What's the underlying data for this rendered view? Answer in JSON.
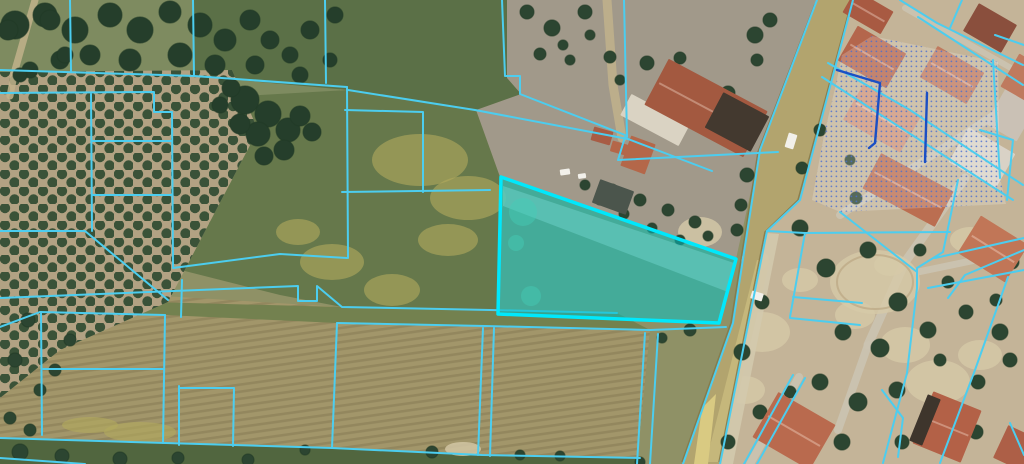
{
  "map": {
    "canvas": {
      "width": 1024,
      "height": 464
    },
    "type": "cadastral-parcel-aerial-view",
    "colors": {
      "base_ground": "#8f9166",
      "parcel_line": "#4ccdef",
      "selected_stroke": "#00e8fc",
      "selected_fill": "rgba(0,195,200,0.52)",
      "navy_line": "#1b4fc4",
      "stipple_dot": "#4a6ed0",
      "stipple_wash": "rgba(255,255,255,0.20)",
      "road_fill": "#b2a46e",
      "road_light": "#c9bb7e",
      "road_wedge": "#d9ca82",
      "road_edge": "#847849",
      "sidewalk": "#d3c9ad",
      "street_gray": "#cbc3b1",
      "tree_dark": "#2c4531",
      "tree_rim": "#223a27",
      "olive_tree": "#3a5238",
      "grove_soil": "#b2a283",
      "sand_patch": "#d6c9a8",
      "flower_patch": "#b3aa5e",
      "tan_path": "#c1b18b",
      "rows_stroke": "rgba(80,65,40,0.18)",
      "white_object": "#f2f0ea"
    },
    "fields": [
      {
        "n": "top-left-grass",
        "p": "0,0 340,0 340,100 0,100",
        "f": "#7e8b60"
      },
      {
        "n": "residential-right",
        "p": "853,0 1024,0 1024,464 720,464 767,231 800,200",
        "f": "#c4b498"
      },
      {
        "n": "dirt-area-center",
        "p": "507,0 817,0 760,150 736,259 500,177 476,110 521,94 507,78",
        "f": "#a1998a"
      },
      {
        "n": "top-center-field",
        "p": "193,0 507,0 507,78 521,94 476,110 348,90 194,76",
        "f": "#5b7047"
      },
      {
        "n": "small-parcels-left",
        "p": "91,93 173,100 173,268 120,280 91,231",
        "f": "#6d7e52"
      },
      {
        "n": "center-green-block",
        "p": "173,100 348,90 476,110 500,177 499,314 342,307 280,295 173,268",
        "f": "#66784b"
      },
      {
        "n": "brown-strip-fields",
        "p": "0,286 342,307 490,310 617,313 650,330 637,464 0,464",
        "f": "#a2966a",
        "rows": true
      },
      {
        "n": "grass-band",
        "p": "0,298 342,307 617,313 650,330 337,323 165,315 40,312 0,327",
        "f": "#73814f"
      },
      {
        "n": "bottom-green-band",
        "p": "0,438 332,448 482,455 640,458 637,464 0,464",
        "f": "#51663f"
      }
    ],
    "grove": {
      "p": "0,72 232,70 258,130 168,302 60,350 0,398",
      "soil": "#b2a283"
    },
    "tan_paths": [
      {
        "pts": "35,0 15,70 10,96",
        "w": 7
      },
      {
        "pts": "607,0 613,85 622,138",
        "w": 9
      }
    ],
    "streets": [
      {
        "pts": "965,178 905,262 868,345",
        "w": 9
      },
      {
        "pts": "840,215 1005,108",
        "w": 8
      },
      {
        "pts": "918,272 1024,250",
        "w": 7
      },
      {
        "pts": "905,8 1018,72",
        "w": 6
      },
      {
        "pts": "868,345 838,430",
        "w": 8
      },
      {
        "pts": "799,377 750,464",
        "w": 8
      }
    ],
    "sand_patches": [
      [
        875,
        282,
        45,
        32
      ],
      [
        762,
        332,
        28,
        20
      ],
      [
        938,
        382,
        32,
        22
      ],
      [
        700,
        232,
        22,
        15
      ],
      [
        905,
        345,
        25,
        18
      ],
      [
        855,
        315,
        20,
        14
      ],
      [
        980,
        355,
        22,
        15
      ],
      [
        745,
        390,
        20,
        14
      ],
      [
        800,
        280,
        18,
        12
      ],
      [
        970,
        240,
        20,
        13
      ],
      [
        890,
        265,
        16,
        11
      ],
      [
        755,
        260,
        14,
        10
      ],
      [
        463,
        449,
        18,
        7
      ]
    ],
    "dirt_ring": [
      875,
      282,
      38,
      27
    ],
    "flower_patches": [
      [
        420,
        160,
        48,
        26
      ],
      [
        468,
        198,
        38,
        22
      ],
      [
        332,
        262,
        32,
        18
      ],
      [
        392,
        290,
        28,
        16
      ],
      [
        298,
        232,
        22,
        13
      ],
      [
        448,
        240,
        30,
        16
      ],
      [
        140,
        432,
        36,
        10
      ],
      [
        90,
        425,
        28,
        8
      ]
    ],
    "road": {
      "body": "817,0 853,0 800,200 767,231 720,464 683,464 733,323 760,150",
      "light": "757,260 770,260 722,462 706,462",
      "wedge": "702,408 716,394 708,464 694,464",
      "edge_left": "815,4 758,152 731,323 682,462",
      "edge_right": "851,4 798,200 765,232 719,462",
      "sidewalk": "767,233 779,234 733,464 721,464"
    },
    "tree_clusters": [
      [
        15,
        25,
        14
      ],
      [
        45,
        15,
        12
      ],
      [
        75,
        30,
        13
      ],
      [
        110,
        15,
        12
      ],
      [
        140,
        30,
        13
      ],
      [
        170,
        12,
        11
      ],
      [
        200,
        25,
        12
      ],
      [
        225,
        40,
        11
      ],
      [
        90,
        55,
        10
      ],
      [
        130,
        60,
        11
      ],
      [
        180,
        55,
        12
      ],
      [
        215,
        65,
        10
      ],
      [
        60,
        60,
        9
      ],
      [
        30,
        70,
        8
      ],
      [
        250,
        20,
        10
      ],
      [
        270,
        40,
        9
      ],
      [
        255,
        65,
        9
      ],
      [
        290,
        55,
        8
      ],
      [
        310,
        30,
        9
      ],
      [
        335,
        15,
        8
      ],
      [
        300,
        75,
        8
      ],
      [
        330,
        60,
        7
      ],
      [
        8,
        30,
        10
      ],
      [
        50,
        20,
        10
      ],
      [
        65,
        55,
        8
      ],
      [
        20,
        75,
        7
      ],
      [
        245,
        100,
        14
      ],
      [
        268,
        114,
        13
      ],
      [
        288,
        130,
        12
      ],
      [
        258,
        134,
        12
      ],
      [
        240,
        124,
        10
      ],
      [
        300,
        116,
        10
      ],
      [
        312,
        132,
        9
      ],
      [
        284,
        150,
        10
      ],
      [
        264,
        156,
        9
      ],
      [
        231,
        88,
        9
      ],
      [
        220,
        105,
        8
      ]
    ],
    "trees": [
      [
        527,
        12,
        7
      ],
      [
        552,
        28,
        8
      ],
      [
        585,
        12,
        7
      ],
      [
        540,
        54,
        6
      ],
      [
        570,
        60,
        5
      ],
      [
        610,
        57,
        6
      ],
      [
        647,
        63,
        7
      ],
      [
        680,
        58,
        6
      ],
      [
        700,
        88,
        8
      ],
      [
        728,
        93,
        7
      ],
      [
        757,
        60,
        6
      ],
      [
        660,
        93,
        6
      ],
      [
        620,
        80,
        5
      ],
      [
        590,
        35,
        5
      ],
      [
        563,
        45,
        5
      ],
      [
        755,
        35,
        8
      ],
      [
        770,
        20,
        7
      ],
      [
        747,
        175,
        7
      ],
      [
        741,
        205,
        6
      ],
      [
        737,
        230,
        6
      ],
      [
        612,
        190,
        6
      ],
      [
        640,
        200,
        6
      ],
      [
        668,
        210,
        6
      ],
      [
        695,
        222,
        6
      ],
      [
        652,
        228,
        5
      ],
      [
        624,
        214,
        5
      ],
      [
        600,
        200,
        5
      ],
      [
        680,
        240,
        5
      ],
      [
        708,
        236,
        5
      ],
      [
        585,
        185,
        5
      ],
      [
        800,
        228,
        8
      ],
      [
        826,
        268,
        9
      ],
      [
        868,
        250,
        8
      ],
      [
        898,
        302,
        9
      ],
      [
        843,
        332,
        8
      ],
      [
        880,
        348,
        9
      ],
      [
        928,
        330,
        8
      ],
      [
        966,
        312,
        7
      ],
      [
        1000,
        332,
        8
      ],
      [
        820,
        382,
        8
      ],
      [
        858,
        402,
        9
      ],
      [
        897,
        390,
        8
      ],
      [
        742,
        352,
        8
      ],
      [
        762,
        302,
        7
      ],
      [
        978,
        382,
        7
      ],
      [
        1012,
        262,
        7
      ],
      [
        948,
        282,
        6
      ],
      [
        760,
        412,
        7
      ],
      [
        728,
        442,
        7
      ],
      [
        790,
        392,
        6
      ],
      [
        842,
        442,
        8
      ],
      [
        976,
        432,
        7
      ],
      [
        902,
        442,
        7
      ],
      [
        856,
        198,
        6
      ],
      [
        930,
        205,
        7
      ],
      [
        820,
        130,
        6
      ],
      [
        802,
        168,
        6
      ],
      [
        850,
        160,
        5
      ],
      [
        920,
        250,
        6
      ],
      [
        1010,
        360,
        7
      ],
      [
        940,
        360,
        6
      ],
      [
        996,
        300,
        6
      ],
      [
        690,
        330,
        6
      ],
      [
        662,
        338,
        5
      ],
      [
        20,
        452,
        8
      ],
      [
        62,
        456,
        7
      ],
      [
        120,
        459,
        7
      ],
      [
        178,
        458,
        6
      ],
      [
        248,
        460,
        6
      ],
      [
        305,
        450,
        5
      ],
      [
        432,
        452,
        6
      ],
      [
        520,
        455,
        5
      ],
      [
        560,
        456,
        5
      ],
      [
        640,
        462,
        5
      ],
      [
        28,
        320,
        7
      ],
      [
        15,
        360,
        7
      ],
      [
        40,
        390,
        6
      ],
      [
        10,
        418,
        6
      ],
      [
        55,
        370,
        6
      ],
      [
        30,
        430,
        6
      ],
      [
        70,
        340,
        6
      ]
    ],
    "buildings": [
      {
        "cx": 868,
        "cy": 12,
        "w": 44,
        "h": 26,
        "rot": 30,
        "f": "#a85a42",
        "ridge": true
      },
      {
        "cx": 872,
        "cy": 57,
        "w": 56,
        "h": 40,
        "rot": 30,
        "f": "#b4664c",
        "ridge": true
      },
      {
        "cx": 952,
        "cy": 75,
        "w": 54,
        "h": 36,
        "rot": 30,
        "f": "#bf7a5e",
        "ridge": true
      },
      {
        "cx": 990,
        "cy": 28,
        "w": 44,
        "h": 32,
        "rot": 30,
        "f": "#8a4f3d",
        "ridge": false
      },
      {
        "cx": 882,
        "cy": 118,
        "w": 66,
        "h": 42,
        "rot": 30,
        "f": "#ce9478",
        "ridge": true
      },
      {
        "cx": 982,
        "cy": 158,
        "w": 54,
        "h": 40,
        "rot": 30,
        "f": "#d9d2c6",
        "ridge": false
      },
      {
        "cx": 1014,
        "cy": 110,
        "w": 36,
        "h": 52,
        "rot": 30,
        "f": "#cac1b5",
        "ridge": false
      },
      {
        "cx": 908,
        "cy": 190,
        "w": 82,
        "h": 40,
        "rot": 28,
        "f": "#bb6e51",
        "ridge": true
      },
      {
        "cx": 993,
        "cy": 249,
        "w": 56,
        "h": 44,
        "rot": 32,
        "f": "#c17657",
        "ridge": true
      },
      {
        "cx": 655,
        "cy": 120,
        "w": 66,
        "h": 24,
        "rot": 28,
        "f": "#dad3c3",
        "ridge": false
      },
      {
        "cx": 706,
        "cy": 108,
        "w": 112,
        "h": 52,
        "rot": 28,
        "f": "#a35940",
        "ridge": true
      },
      {
        "cx": 737,
        "cy": 122,
        "w": 52,
        "h": 40,
        "rot": 28,
        "f": "#43392f",
        "ridge": false
      },
      {
        "cx": 638,
        "cy": 155,
        "w": 26,
        "h": 32,
        "rot": 20,
        "f": "#b46749",
        "ridge": false
      },
      {
        "cx": 602,
        "cy": 136,
        "w": 20,
        "h": 14,
        "rot": 16,
        "f": "#a85c44",
        "ridge": false
      },
      {
        "cx": 619,
        "cy": 148,
        "w": 16,
        "h": 11,
        "rot": 16,
        "f": "#b46749",
        "ridge": false
      },
      {
        "cx": 613,
        "cy": 197,
        "w": 36,
        "h": 25,
        "rot": 20,
        "f": "#4b554c",
        "ridge": false
      },
      {
        "cx": 794,
        "cy": 431,
        "w": 66,
        "h": 52,
        "rot": 30,
        "f": "#b96a4e",
        "ridge": true
      },
      {
        "cx": 947,
        "cy": 427,
        "w": 52,
        "h": 56,
        "rot": 22,
        "f": "#b36147",
        "ridge": true
      },
      {
        "cx": 925,
        "cy": 420,
        "w": 14,
        "h": 50,
        "rot": 22,
        "f": "#3e352c",
        "ridge": false
      },
      {
        "cx": 1017,
        "cy": 449,
        "w": 36,
        "h": 36,
        "rot": 25,
        "f": "#ad5f47",
        "ridge": false
      },
      {
        "cx": 1022,
        "cy": 77,
        "w": 28,
        "h": 38,
        "rot": 30,
        "f": "#bf7a5e",
        "ridge": false
      }
    ],
    "white_objects": [
      [
        791,
        141,
        9,
        15,
        17
      ],
      [
        757,
        296,
        12,
        8,
        17
      ],
      [
        565,
        172,
        10,
        6,
        -8
      ],
      [
        582,
        176,
        8,
        5,
        -8
      ]
    ],
    "selected_parcel": {
      "points": "501,177 736,259 719,323 498,314",
      "inner_light_band": "503,186 734,263 728,292 503,206",
      "inner_green_patches": [
        [
          523,
          212,
          14
        ],
        [
          531,
          296,
          10
        ],
        [
          516,
          243,
          8
        ]
      ]
    },
    "stipple_zone": {
      "p": "842,55 872,36 998,62 1000,178 1006,204 840,212 812,200 824,135 836,84"
    },
    "parcel_lines": [
      "70,0 71,71",
      "0,70 194,76",
      "193,0 194,76",
      "194,76 347,87",
      "325,0 326,83",
      "347,87 348,258",
      "0,93 154,92 154,112 172,112 173,268",
      "91,94 92,231",
      "92,141 172,141",
      "92,195 172,195",
      "0,231 85,231 168,300",
      "173,268 280,254 347,258",
      "348,90 475,110 628,139 712,171",
      "502,0 505,76 520,76 520,94 625,135",
      "624,0 627,137",
      "625,137 618,160 778,152",
      "345,110 423,112 423,192",
      "342,192 490,190",
      "0,298 298,286 298,301 317,301 317,286 342,307 490,310 617,313",
      "337,323 485,326 650,330 726,327",
      "337,323 332,448",
      "483,328 478,455",
      "494,328 490,456",
      "0,438 332,448 482,455 640,458",
      "0,458 85,464",
      "645,333 637,464",
      "658,334 650,464",
      "40,312 0,327",
      "40,312 165,315",
      "41,312 42,435",
      "165,315 163,443",
      "43,369 163,369",
      "182,280 181,317",
      "179,386 179,445",
      "179,388 234,388 233,446",
      "817,0 760,150 733,323 683,464",
      "853,0 800,200 767,231 720,464",
      "767,231 805,233 950,232",
      "958,180 943,252 917,268 917,288 907,373 883,463",
      "1008,277 975,370 940,463",
      "840,212 917,272",
      "935,258 1024,238",
      "928,288 1024,270",
      "900,0 937,23 1023,65",
      "918,17 1023,85",
      "828,63 910,110 1023,185",
      "822,77 1013,200",
      "993,60 1000,178",
      "980,130 1013,140 1007,200",
      "793,375 744,464",
      "805,378 757,464",
      "882,390 903,418 898,457",
      "1010,423 1024,455",
      "790,318 860,325",
      "793,297 862,303",
      "805,233 790,317",
      "962,0 950,28",
      "995,35 1024,45",
      "1024,250 965,275 948,298"
    ],
    "navy_lines": [
      "837,70 880,83 875,143 869,148",
      "927,93 925,162"
    ]
  }
}
